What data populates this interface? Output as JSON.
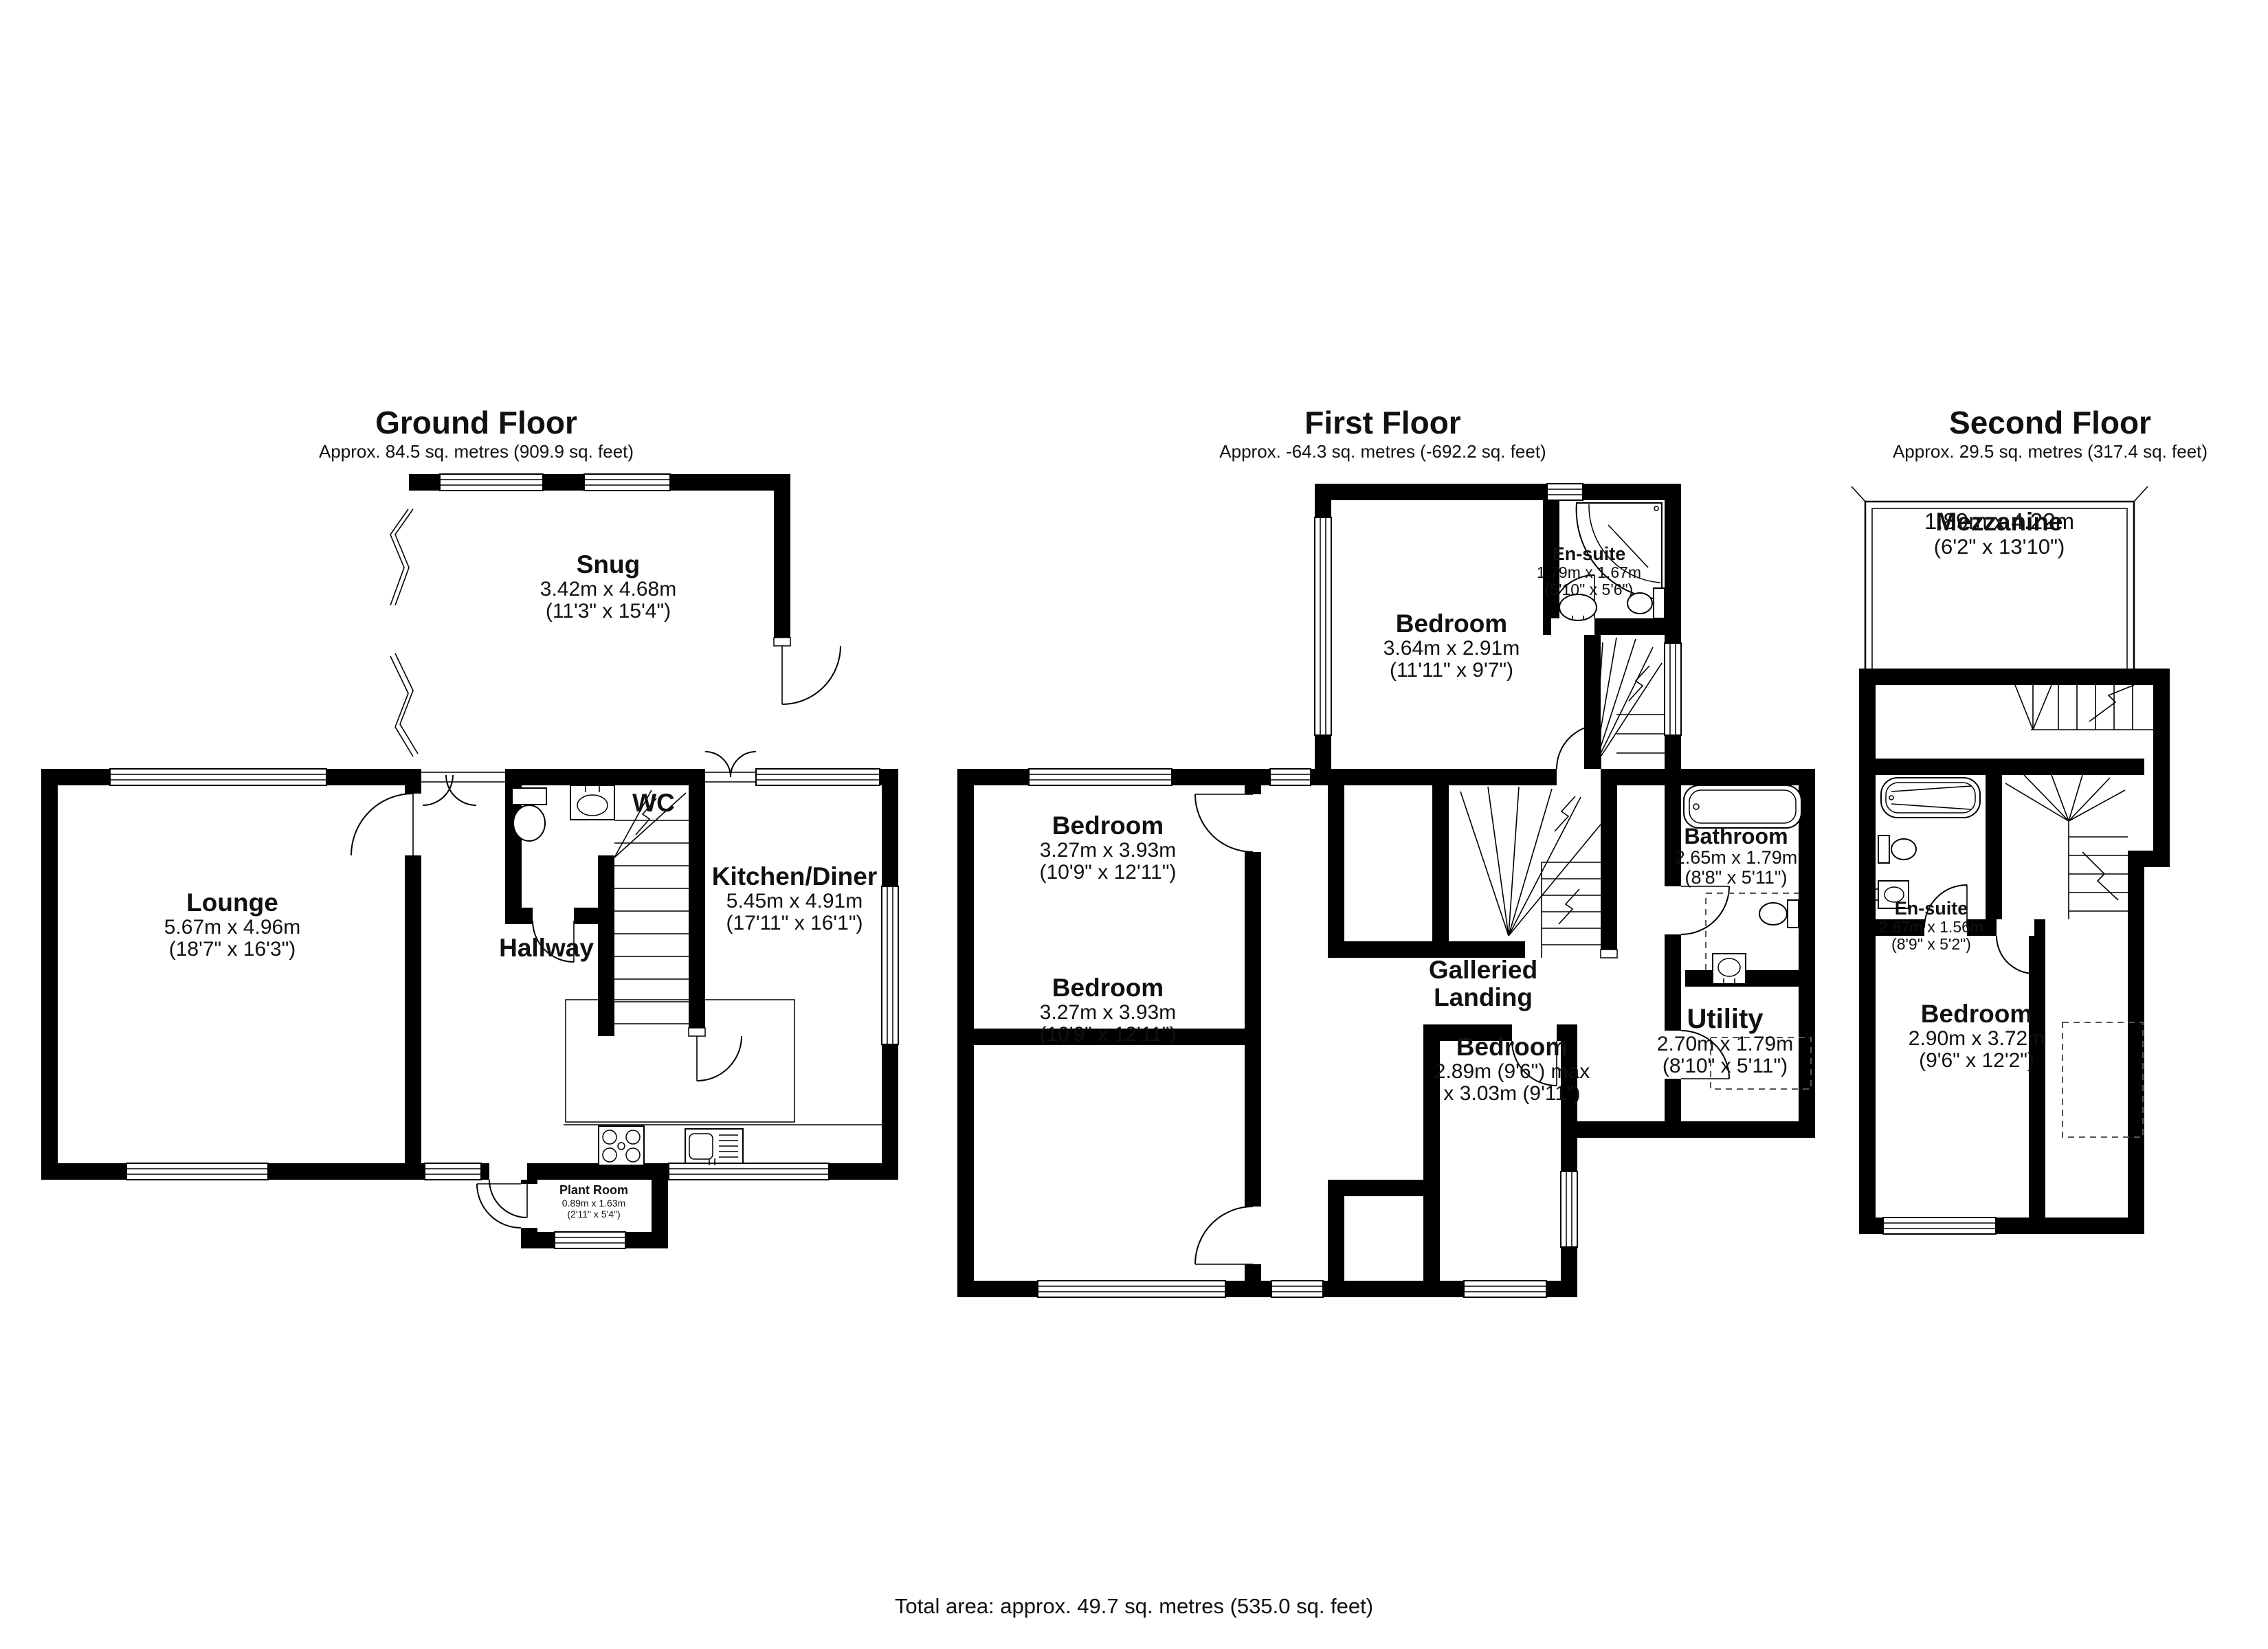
{
  "page": {
    "background": "#ffffff",
    "wall_color": "#000000"
  },
  "floors": [
    {
      "title": "Ground Floor",
      "subtitle": "Approx. 84.5 sq. metres (909.9 sq. feet)",
      "rooms": [
        {
          "name": "Snug",
          "metric": "3.42m x 4.68m",
          "imperial": "(11'3\" x 15'4\")"
        },
        {
          "name": "Lounge",
          "metric": "5.67m x 4.96m",
          "imperial": "(18'7\" x 16'3\")"
        },
        {
          "name": "WC"
        },
        {
          "name": "Hallway"
        },
        {
          "name": "Kitchen/Diner",
          "metric": "5.45m x 4.91m",
          "imperial": "(17'11\" x 16'1\")"
        },
        {
          "name": "Plant Room",
          "metric": "0.89m x 1.63m",
          "imperial": "(2'11\" x 5'4\")"
        }
      ]
    },
    {
      "title": "First Floor",
      "subtitle": "Approx. -64.3 sq. metres (-692.2 sq. feet)",
      "rooms": [
        {
          "name": "Bedroom",
          "metric": "3.64m x 2.91m",
          "imperial": "(11'11\" x 9'7\")"
        },
        {
          "name": "En-suite",
          "metric": "1.79m x 1.67m",
          "imperial": "(5'10\" x 5'6\")"
        },
        {
          "name": "Bedroom",
          "metric": "3.27m x 3.93m",
          "imperial": "(10'9\" x 12'11\")"
        },
        {
          "name": "Bedroom",
          "metric": "3.27m x 3.93m",
          "imperial": "(10'9\" x 12'11\")"
        },
        {
          "name": "Bathroom",
          "metric": "2.65m x 1.79m",
          "imperial": "(8'8\" x 5'11\")"
        },
        {
          "name": "Galleried Landing"
        },
        {
          "name": "Bedroom",
          "metric": "2.89m (9'6\") max",
          "imperial": "x 3.03m (9'11\")"
        },
        {
          "name": "Utility",
          "metric": "2.70m x 1.79m",
          "imperial": "(8'10\" x 5'11\")"
        }
      ]
    },
    {
      "title": "Second Floor",
      "subtitle": "Approx. 29.5 sq. metres (317.4 sq. feet)",
      "rooms": [
        {
          "name": "Mezzanine",
          "metric": "1.89m x 4.22m",
          "imperial": "(6'2\" x 13'10\")"
        },
        {
          "name": "En-suite",
          "metric": "2.67m x 1.56m",
          "imperial": "(8'9\" x 5'2\")"
        },
        {
          "name": "Bedroom",
          "metric": "2.90m x 3.72m",
          "imperial": "(9'6\" x 12'2\")"
        }
      ]
    }
  ],
  "footer": {
    "total": "Total area: approx. 49.7 sq. metres (535.0 sq. feet)"
  }
}
